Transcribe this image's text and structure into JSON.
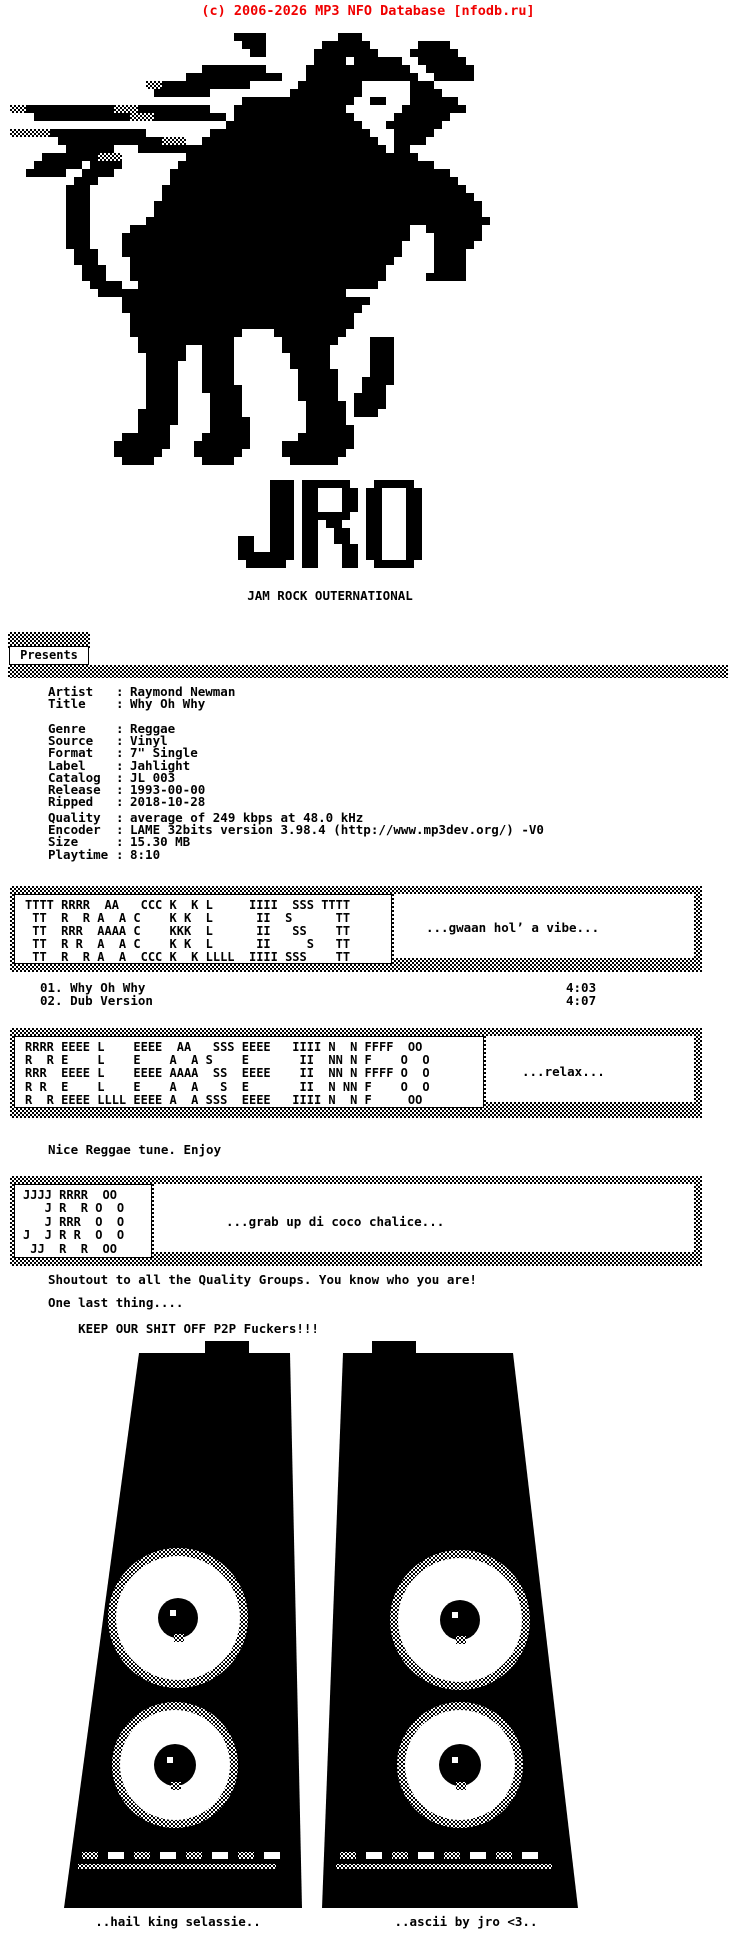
{
  "header": {
    "copyright": "(c) 2006-2026 MP3 NFO Database [nfodb.ru]",
    "accent_color": "#f00000"
  },
  "group": {
    "initials": "JRO",
    "name": "JAM ROCK OUTERNATIONAL",
    "presents_label": "Presents"
  },
  "release": {
    "identity_rows": [
      {
        "label": "Artist",
        "sep": ":",
        "value": "Raymond Newman"
      },
      {
        "label": "Title",
        "sep": ":",
        "value": "Why Oh Why"
      }
    ],
    "media_rows": [
      {
        "label": "Genre",
        "sep": ":",
        "value": "Reggae"
      },
      {
        "label": "Source",
        "sep": ":",
        "value": "Vinyl"
      },
      {
        "label": "Format",
        "sep": ":",
        "value": "7\" Single"
      },
      {
        "label": "Label",
        "sep": ":",
        "value": "Jahlight"
      },
      {
        "label": "Catalog",
        "sep": ":",
        "value": "JL 003"
      },
      {
        "label": "Release",
        "sep": ":",
        "value": "1993-00-00"
      },
      {
        "label": "Ripped",
        "sep": ":",
        "value": "2018-10-28"
      }
    ],
    "rip_rows": [
      {
        "label": "Quality",
        "sep": ":",
        "value": "average of 249 kbps at 48.0 kHz"
      },
      {
        "label": "Encoder",
        "sep": ":",
        "value": "LAME 32bits version 3.98.4 (http://www.mp3dev.org/) -V0"
      },
      {
        "label": "Size",
        "sep": ":",
        "value": "15.30 MB"
      },
      {
        "label": "Playtime",
        "sep": ":",
        "value": "8:10"
      }
    ]
  },
  "tracklist_banner": {
    "ascii": "TTTT RRRR  AA   CCC K  K L     IIII  SSS TTTT\n TT  R  R A  A C    K K  L      II  S      TT\n TT  RRR  AAAA C    KKK  L      II   SS    TT\n TT  R R  A  A C    K K  L      II     S   TT\n TT  R  R A  A  CCC K  K LLLL  IIII SSS    TT",
    "quote": "...gwaan hol’ a vibe..."
  },
  "tracks": [
    {
      "num": "01.",
      "title": "Why Oh Why",
      "time": "4:03"
    },
    {
      "num": "02.",
      "title": "Dub Version",
      "time": "4:07"
    }
  ],
  "releaseinfo_banner": {
    "ascii": "RRRR EEEE L    EEEE  AA   SSS EEEE   IIII N  N FFFF  OO \nR  R E    L    E    A  A S    E       II  NN N F    O  O\nRRR  EEEE L    EEEE AAAA  SS  EEEE    II  NN N FFFF O  O\nR R  E    L    E    A  A   S  E       II  N NN F    O  O\nR  R EEEE LLLL EEEE A  A SSS  EEEE   IIII N  N F     OO ",
    "quote": "...relax..."
  },
  "notes": {
    "line1": "Nice Reggae tune. Enjoy"
  },
  "jro_banner": {
    "ascii": "JJJJ RRRR  OO \n   J R  R O  O\n   J RRR  O  O\nJ  J R R  O  O\n JJ  R  R  OO ",
    "quote": "...grab up di coco chalice..."
  },
  "shoutouts": {
    "line1": "Shoutout to all the Quality Groups. You know who you are!",
    "line2": "One last thing....",
    "line3": "KEEP OUR SHIT OFF P2P Fuckers!!!"
  },
  "footer": {
    "left": "..hail king selassie..",
    "right": "..ascii by jro <3.."
  },
  "artwork": {
    "lion": {
      "origin": [
        10,
        33
      ],
      "cell": 8,
      "rows": [
        "                            ####         ###                ",
        "                             ###       ######      ####    ",
        "                              ##      ########    ######   ",
        "                                      #### ######  ######   ",
        "                        ########     #############  ######  ",
        "                      ############   ##############  #####  ",
        "                 ++###########      ########      ###       ",
        "                  #######          #########      ####      ",
        "                             ##############  ##   ######    ",
        "++###########+++#########   ##############       ########   ",
        "   ############+++#########.###############     #######     ",
        "                           #################   #######      ",
        "+++++############        ####################   #####       ",
        "      #############+++  ######################  ####        ",
        "       ######   ############################### ##         ",
        "    #######+++        #############################         ",
        "   ###### ####       ################################       ",
        "  #####  ####       ###################################     ",
        "        ###         ####################################    ",
        "       ###         ######################################   ",
        "       ###         #######################################  ",
        "       ###        ######################################### ",
        "       ###        ######################################### ",
        "       ###       ###########################################",
        "       ###     ###################################  ####### ",
        "       ###    ####################################   ###### ",
        "       ###    ###################################    #####  ",
        "        ###   ###################################    ####   ",
        "        ###    #################################     ####   ",
        "         ###   ################################      ####   ",
        "         ###   ################################     #####   ",
        "          ####  ##############################              ",
        "           ###############################                  ",
        "              ###############################               ",
        "              ##############################                ",
        "               ############################                 ",
        "               ############################                 ",
        "               ##############    #########                  ",
        "                ############      #######    ###            ",
        "                ######  ####      ######     ###            ",
        "                 #####  ####       #####     ###            ",
        "                 ####   ####       #####     ###            ",
        "                 ####   ####        #####    ###            ",
        "                 ####   ####        #####   ####            ",
        "                 ####   #####       #####   ###             ",
        "                 ####    ####       #####  ####             ",
        "                 ####    ####        ##### ####             ",
        "                #####    ####        ##### ###              ",
        "                #####    #####       #####                  ",
        "                ####     #####       ######                 ",
        "              ######    ######      #######                 ",
        "             #######   #######    #########                 ",
        "             ######    ######     ########                  ",
        "              ####      ####       ######                   "
      ]
    },
    "jro_logo": {
      "origin": [
        238,
        480
      ],
      "cell": 8,
      "rows": [
        "....### ######. .#####.",
        "....### ##...## ##...##",
        "....### ##...## ##...##",
        "....### ##...## ##...##",
        "....### ######. ##...##",
        "....### ##.##.. ##...##",
        "....### ##..##. ##...##",
        "##..### ##..##. ##...##",
        "##..### ##...## ##...##",
        "####### ##...## ##...##",
        ".#####. ##...## .#####."
      ]
    },
    "speakers": {
      "origin": [
        55,
        1335
      ],
      "left": {
        "topX1": 84,
        "topX2": 235,
        "botX1": 9,
        "botX2": 247,
        "topY": 18,
        "botY": 573,
        "bits": [
          [
            150,
            6,
            44,
            14
          ]
        ],
        "circles": [
          {
            "cx": 123,
            "cy": 283,
            "r": 62,
            "core": 20
          },
          {
            "cx": 120,
            "cy": 430,
            "r": 55,
            "core": 21
          }
        ],
        "stripeY": 517
      },
      "right": {
        "topX1": 288,
        "topX2": 458,
        "botX1": 267,
        "botX2": 523,
        "topY": 18,
        "botY": 573,
        "bits": [
          [
            317,
            6,
            44,
            14
          ]
        ],
        "circles": [
          {
            "cx": 405,
            "cy": 285,
            "r": 62,
            "core": 20
          },
          {
            "cx": 405,
            "cy": 430,
            "r": 55,
            "core": 21
          }
        ],
        "stripeY": 517
      }
    }
  }
}
